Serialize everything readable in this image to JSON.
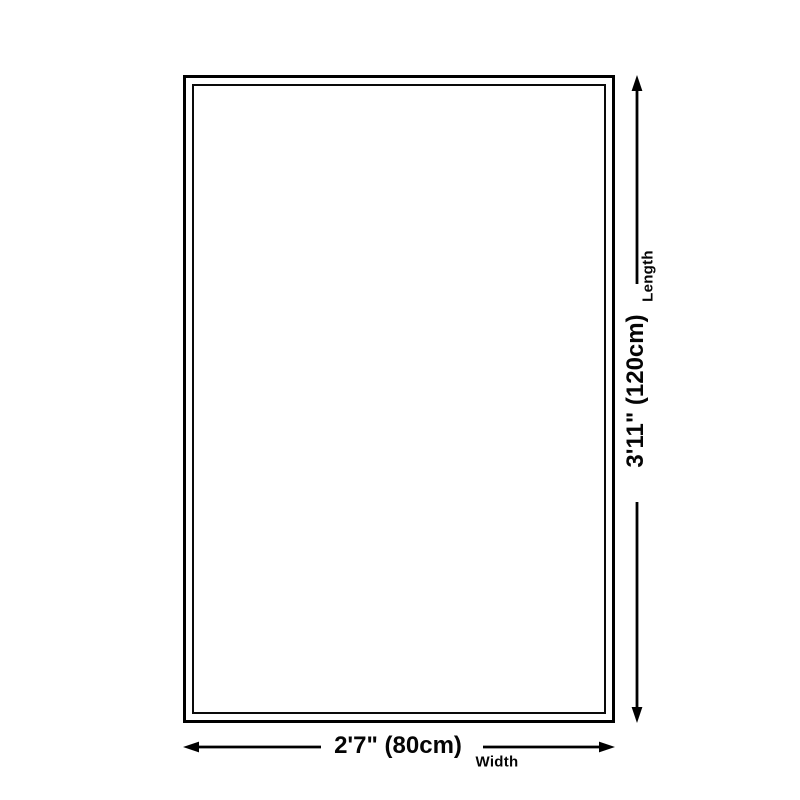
{
  "diagram": {
    "type": "product-size-diagram",
    "background_color": "#ffffff",
    "line_color": "#000000",
    "length": {
      "label": "3'11\" (120cm)",
      "axis_name": "Length",
      "value_imperial": "3'11\"",
      "value_cm": 120
    },
    "width": {
      "label": "2'7\" (80cm)",
      "axis_name": "Width",
      "value_imperial": "2'7\"",
      "value_cm": 80
    }
  }
}
